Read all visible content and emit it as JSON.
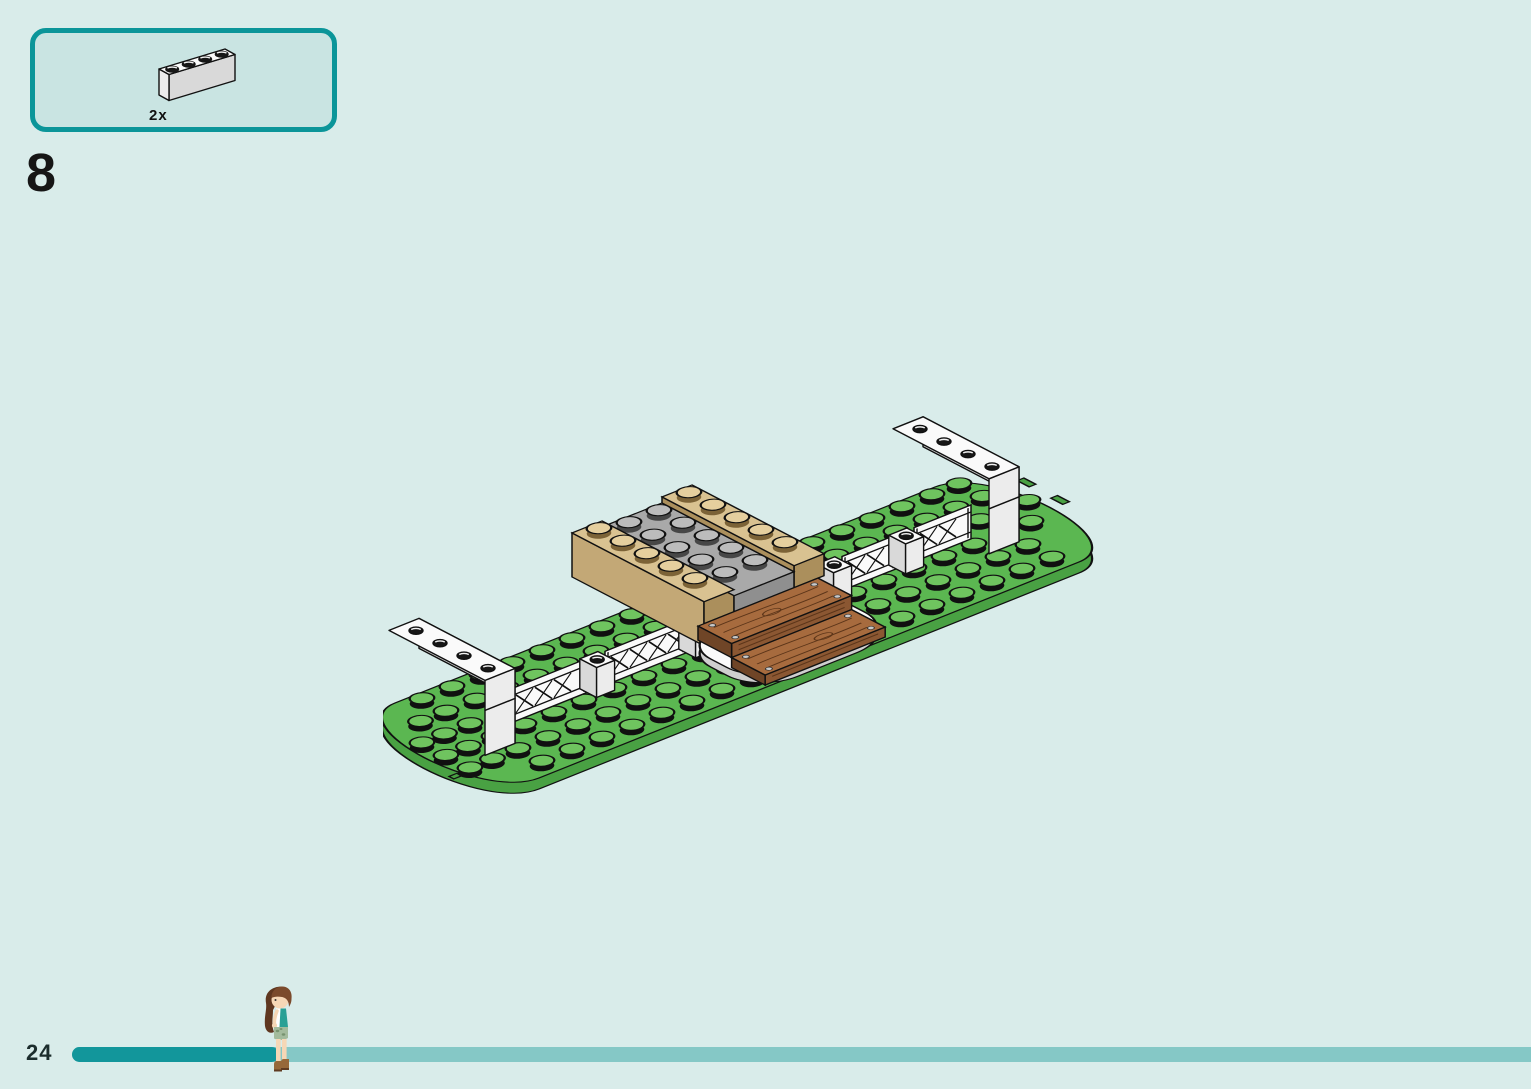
{
  "step": {
    "number": "8"
  },
  "parts_panel": {
    "quantity_label": "2x",
    "part": "white brick 1x4",
    "stud_count": 4
  },
  "footer": {
    "page_number": "24",
    "progress_fraction": 0.14
  },
  "model": {
    "type": "isometric-lego-assembly",
    "parts_visible": [
      "green base plates with studs and rounded ends",
      "white lattice fence segments along center line",
      "white 1x1 posts with studs between fences",
      "white 1x4 bricks raised on posts at both ends",
      "tan 1x6 bricks on center block",
      "gray 2x6 plate between tan bricks",
      "two brown wood-grain plank steps with nails",
      "white curved plate under planks"
    ]
  },
  "colors": {
    "page_bg": "#d9ecea",
    "panel_bg": "#c9e4e2",
    "teal": "#0b9599",
    "ink": "#1a1a1a",
    "bar_fill": "#12969b",
    "bar_track": "#85c8c6",
    "green": "#5bb751",
    "green_side": "#49a143",
    "green_stud": "#6fc45f",
    "tan": "#d9c291",
    "tan_side": "#c3a876",
    "tan_dark": "#ab8f5c",
    "gray": "#a9a9a9",
    "gray_front": "#8f8f8f",
    "white": "#fafafa",
    "white_front": "#ececec",
    "white_side": "#d9d9d9",
    "wood": "#a76b3e",
    "wood_front": "#8b5732",
    "wood_end": "#6f4527",
    "wood_grain": "#5c3519",
    "nail": "#c9c9c9",
    "outline": "#111111",
    "skin": "#f6d7b6",
    "hair": "#7b4a2c",
    "hair_dark": "#5f3720",
    "shirt": "#2aa095",
    "shorts": "#a3bb9c",
    "shorts_dark": "#77936f",
    "boots": "#96683a",
    "boots_dark": "#5f3b22"
  }
}
